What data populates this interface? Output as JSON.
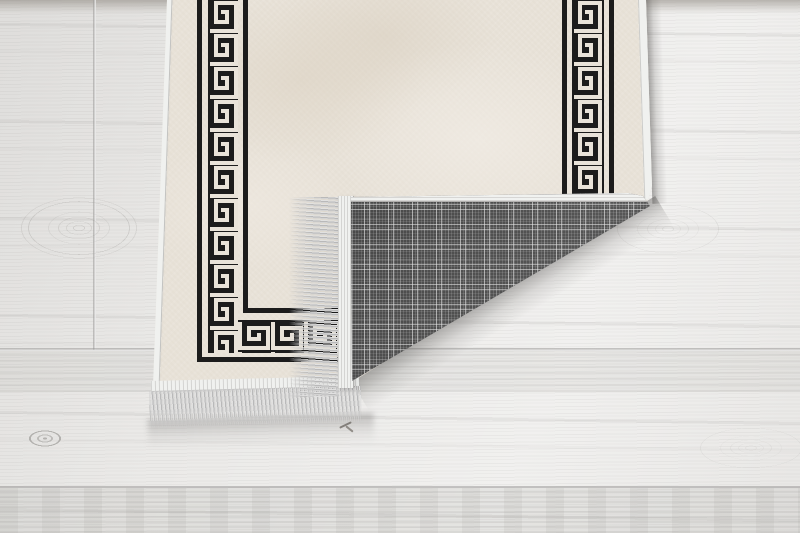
{
  "meta": {
    "type": "product-photo",
    "subject": "Beige runner rug with black Greek key meander border, bottom-right corner folded back to reveal a grey tartan-check woven backing with silver tassel fringe, lying on a whitewashed wood plank floor"
  },
  "scene": {
    "floor": {
      "label": "whitewashed wood plank floor",
      "plank_direction": "horizontal",
      "details": [
        "vertical plank seam upper left",
        "horizontal plank seams",
        "wood knots",
        "grain streaks",
        "small debris twig near bottom center"
      ]
    },
    "rug": {
      "label": "cream-beige rug front",
      "field_color_name": "mottled cream beige",
      "border": {
        "motif": "greek-key-meander",
        "color_name": "black",
        "bands": [
          "inner pinstripe",
          "wide meander band",
          "outer pinstripe"
        ],
        "sides_visible": [
          "left",
          "right",
          "bottom"
        ]
      },
      "edges": "white bound edges, rounded corner at right"
    },
    "fold": {
      "label": "folded-back corner flap",
      "reveals": "grey tartan check woven backing",
      "edge_detail": "white edge binding along fold top, fringe band along flap left edge"
    },
    "fringes": {
      "flap_fringe": "silver tassel fringe pointing left on folded edge",
      "bottom_fringe": "silver tassel fringe hanging below bottom edge"
    },
    "shadows": [
      "soft shadow under fold diagonal",
      "shadow right of rug edge",
      "shadow under bottom fringe"
    ]
  },
  "colors": {
    "floor_base": "#ebeae8",
    "floor_band_top": "#cfcbc7",
    "floor_seam": "#b3b1af",
    "rug_field": "#e8e2d8",
    "rug_field_light": "#f0ebe2",
    "rug_field_dark": "#dcd3c4",
    "pattern_black": "#1c1c1c",
    "pattern_white": "#e9e3d9",
    "edge_binding": "#f0f1ef",
    "plaid_base": "#4a4a4a",
    "plaid_line": "#d6d6d6",
    "fringe_light": "#e1e1e1",
    "fringe_mid": "#b9b9b9",
    "fringe_dark": "#d4d4d4",
    "shadow": "#6e6c6a"
  }
}
